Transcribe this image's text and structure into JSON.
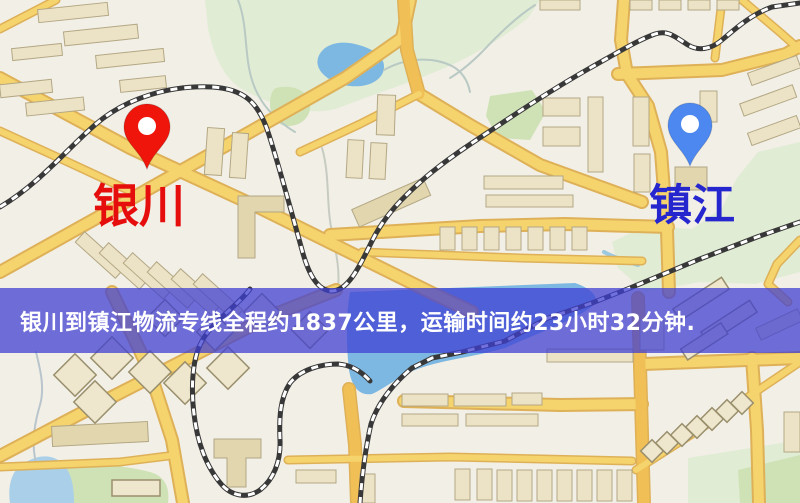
{
  "map": {
    "kind": "road-map-image",
    "colors": {
      "map_bg": "#f2efe6",
      "road_fill": "#f5d36d",
      "road_casing": "#deb158",
      "road_orange": "#f0bf55",
      "rail": "#383838",
      "water": "#7db8e2",
      "water_light": "#a9cfe9",
      "green_light": "#e0ecd4",
      "green_mid": "#cfe2b6",
      "building_fill": "#ece3c6",
      "building_stroke": "#b3a784",
      "building_tan": "#e2d6af",
      "yinchuan_pin": "#f0150b",
      "zhenjiang_pin": "#4c88f0",
      "yinchuan_label": "#e60d0d",
      "zhenjiang_label": "#2626cf",
      "banner_bg": "rgba(64,64,210,0.74)",
      "banner_text": "#ffffff"
    }
  },
  "markers": {
    "yinchuan": {
      "label": "银川"
    },
    "zhenjiang": {
      "label": "镇江"
    }
  },
  "banner": {
    "text": "银川到镇江物流专线全程约1837公里，运输时间约23小时32分钟."
  },
  "route": {
    "origin": "银川",
    "destination": "镇江",
    "distance_text": "全程约1837公里",
    "duration_text": "运输时间约23小时32分钟"
  }
}
